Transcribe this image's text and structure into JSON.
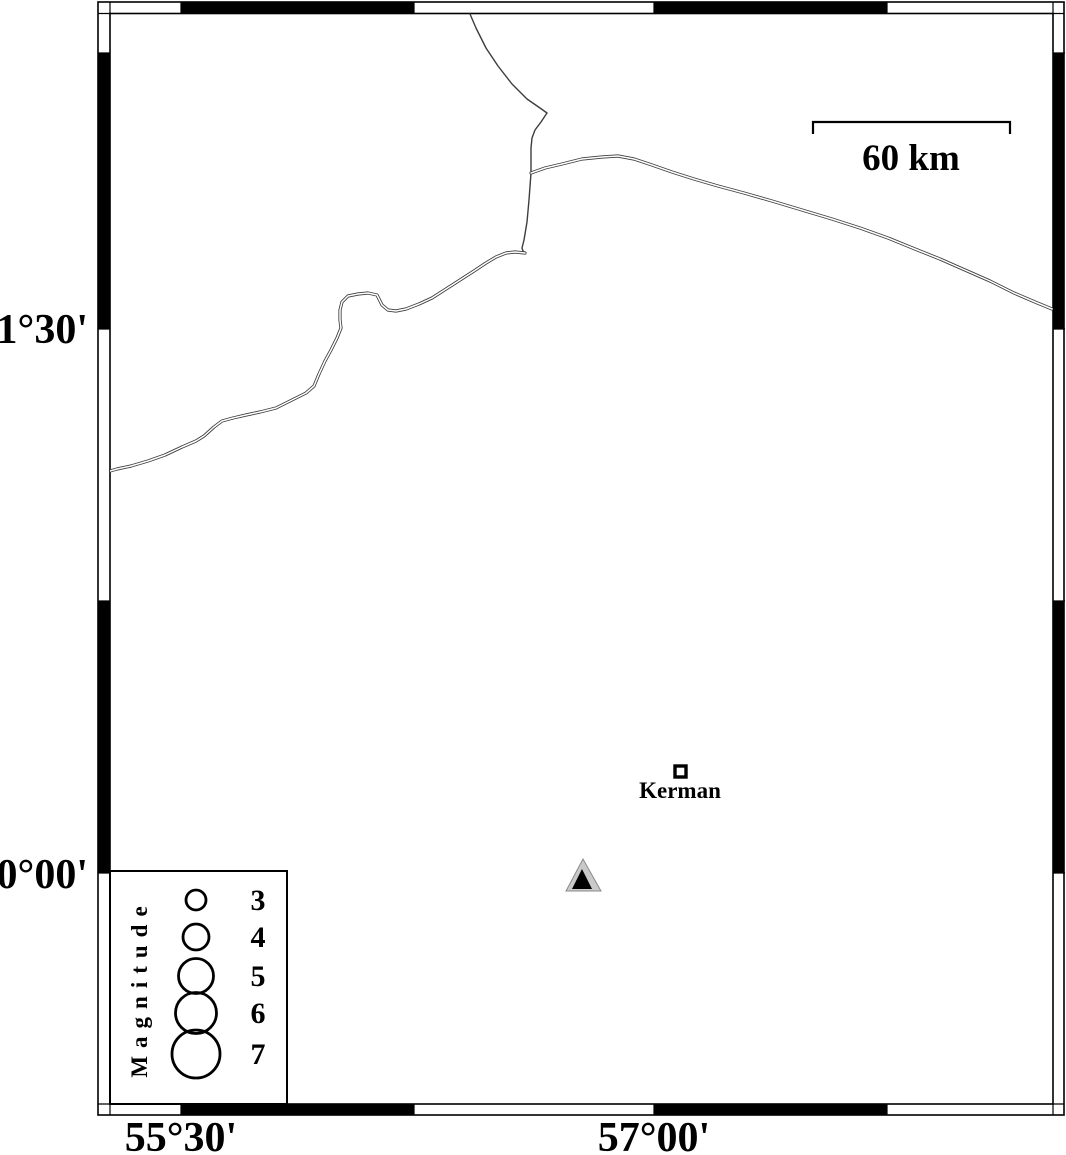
{
  "axis_labels": {
    "lat_upper": "31°30'",
    "lat_lower": "30°00'",
    "lon_left": "55°30'",
    "lon_right": "57°00'"
  },
  "scale_bar": {
    "label": "60 km"
  },
  "city": {
    "label": "Kerman"
  },
  "legend": {
    "title": "Magnitude",
    "entries": [
      {
        "label": "3",
        "radius_px": 10
      },
      {
        "label": "4",
        "radius_px": 13
      },
      {
        "label": "5",
        "radius_px": 17.5
      },
      {
        "label": "6",
        "radius_px": 20.5
      },
      {
        "label": "7",
        "radius_px": 24
      }
    ]
  },
  "colors": {
    "ink": "#000000",
    "road": "#3d3d3d",
    "station_fill": "#c9c9c9",
    "station_inner": "#000000"
  }
}
